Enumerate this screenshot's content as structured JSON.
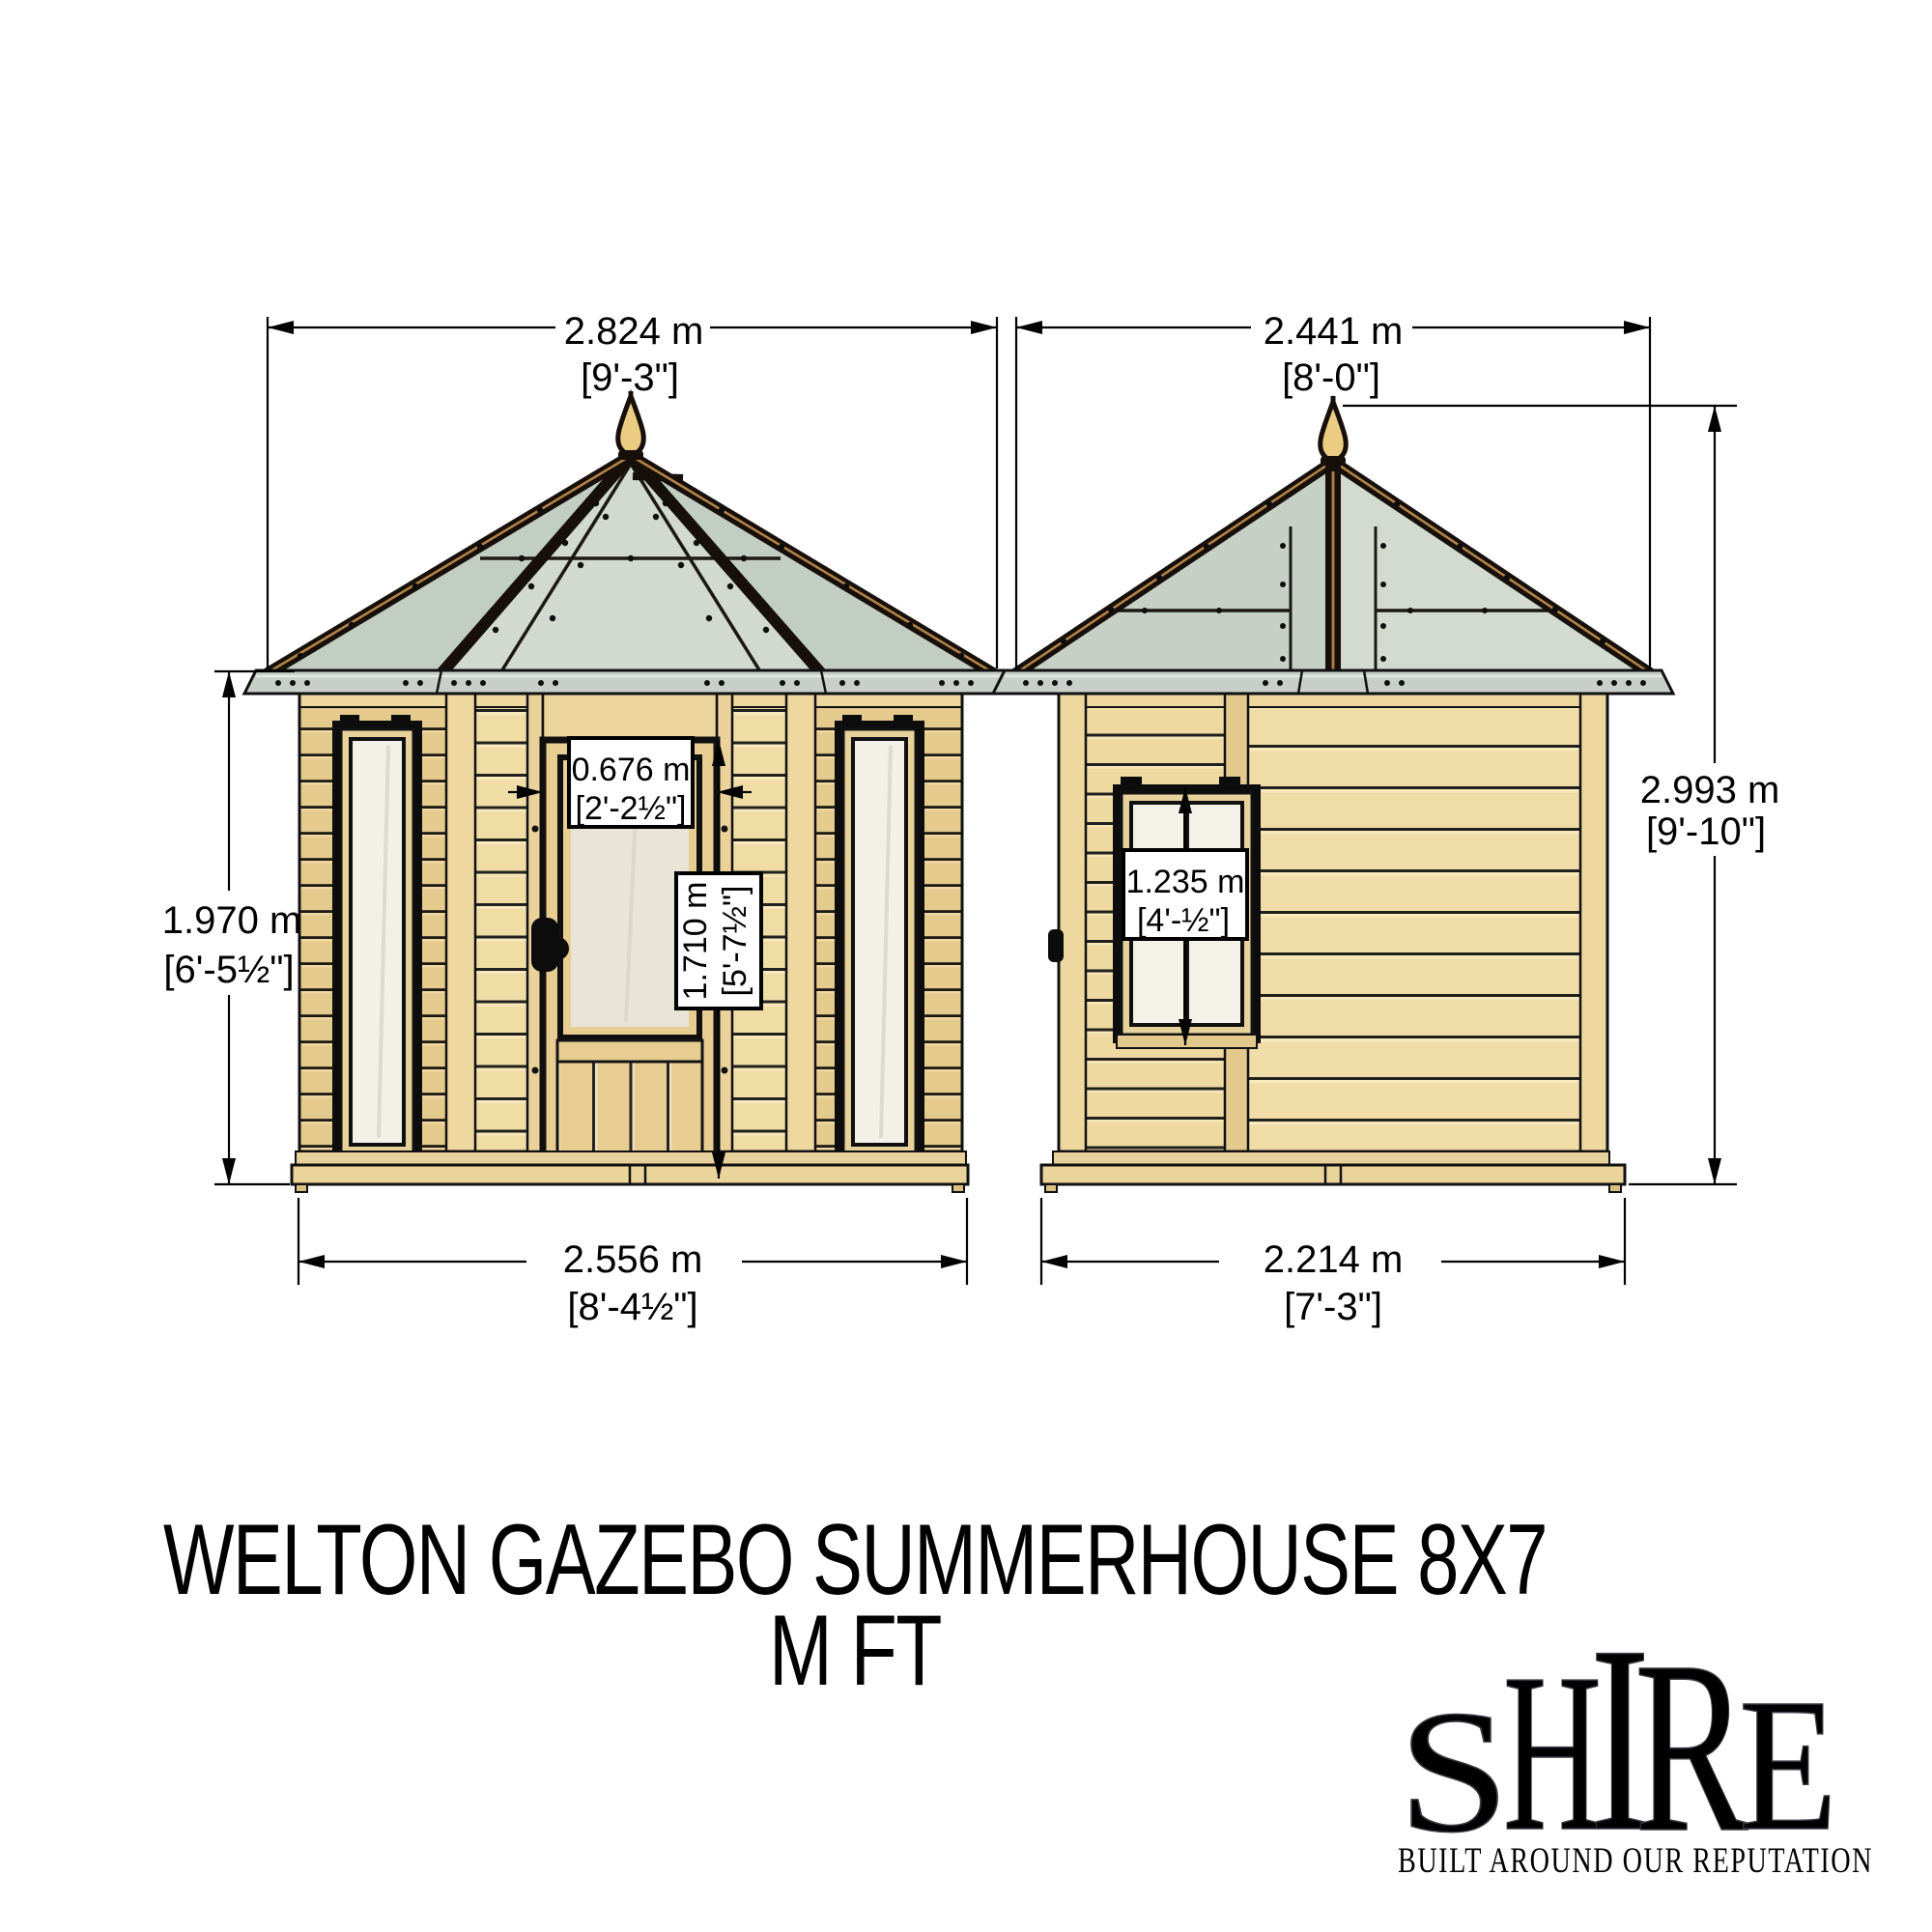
{
  "title": {
    "line1": "WELTON GAZEBO SUMMERHOUSE 8X7",
    "line2": "M FT"
  },
  "front_view": {
    "name": "front elevation",
    "dims": {
      "roof_width": {
        "m": "2.824 m",
        "ft": "[9'-3\"]"
      },
      "wall_height": {
        "m": "1.970 m",
        "ft": "[6'-5½\"]"
      },
      "base_width": {
        "m": "2.556 m",
        "ft": "[8'-4½\"]"
      },
      "door_width": {
        "m": "0.676 m",
        "ft": "[2'-2½\"]"
      },
      "door_height": {
        "m": "1.710 m",
        "ft": "[5'-7½\"]"
      }
    }
  },
  "side_view": {
    "name": "side elevation",
    "dims": {
      "roof_width": {
        "m": "2.441 m",
        "ft": "[8'-0\"]"
      },
      "total_height": {
        "m": "2.993 m",
        "ft": "[9'-10\"]"
      },
      "base_width": {
        "m": "2.214 m",
        "ft": "[7'-3\"]"
      },
      "window_height": {
        "m": "1.235 m",
        "ft": "[4'-½\"]"
      }
    }
  },
  "logo": {
    "letters": {
      "l1": "S",
      "l2": "H",
      "l3": "I",
      "l4": "R",
      "l5": "E"
    },
    "tagline": "BUILT AROUND OUR REPUTATION"
  },
  "colors": {
    "wood_light": "#f0dda6",
    "wood_mid": "#e5ca8e",
    "roof_glazing": "#ccd5cb",
    "roof_frame": "#17100a",
    "frame_stripe": "#b5854a",
    "eave_metal": "#c8cfc9",
    "finial_gold": "#eccb82",
    "glass_window": "#f3f0e7",
    "glass_door": "#e9e4d8",
    "dimension_ink": "#000000"
  }
}
